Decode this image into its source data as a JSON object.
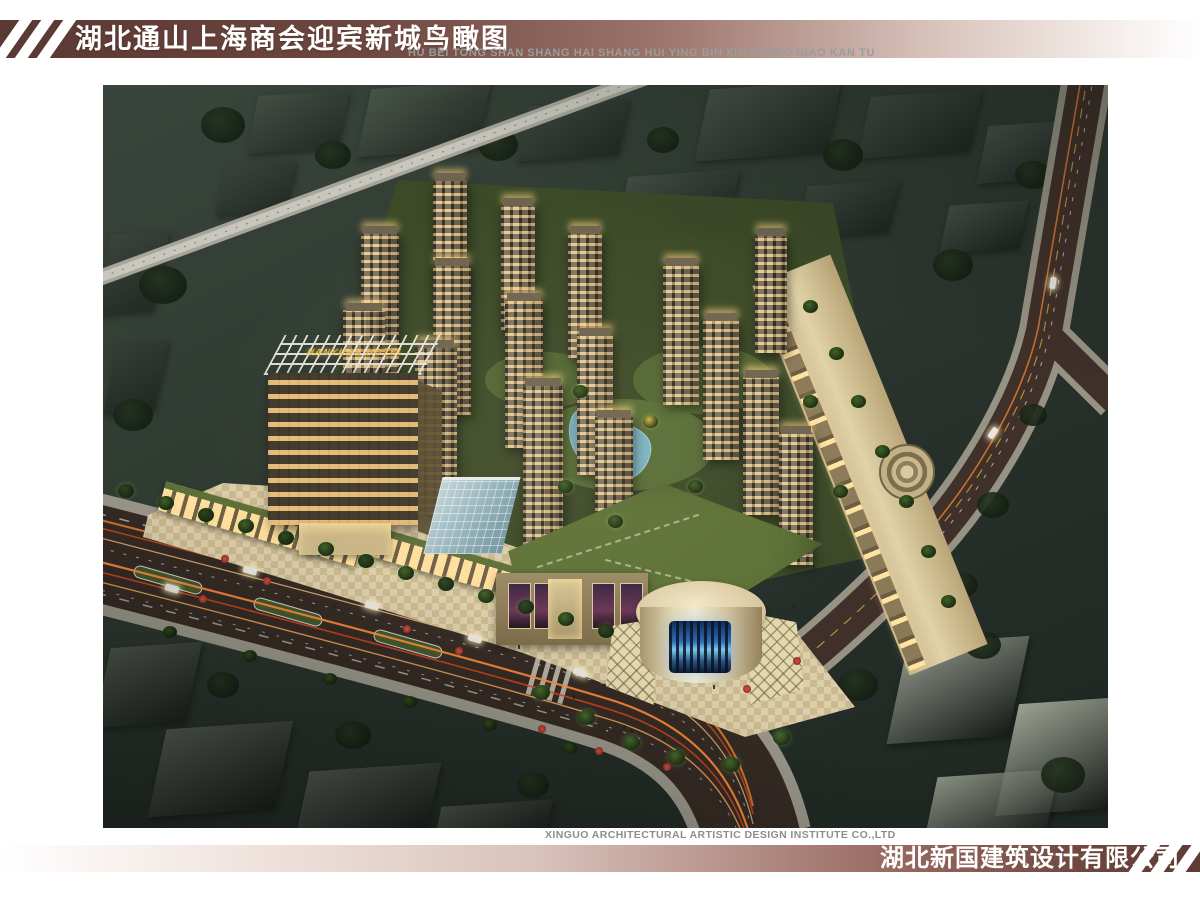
{
  "header": {
    "title": "湖北通山上海商会迎宾新城鸟瞰图",
    "subtitle_pinyin": "HU BEI TONG SHAN SHANG HAI SHANG HUI YING BIN XIN CHENG NIAO KAN TU"
  },
  "rendering": {
    "hotel_sign": "HANYUAN HOTEL"
  },
  "footer": {
    "designer_en": "XINGUO ARCHITECTURAL ARTISTIC DESIGN INSTITUTE CO.,LTD",
    "designer_cn": "湖北新国建筑设计有限公司"
  },
  "colors": {
    "accent_maroon": "#5d3b35",
    "stripe_white": "#ffffff",
    "sign_gold": "#e3b54a"
  }
}
